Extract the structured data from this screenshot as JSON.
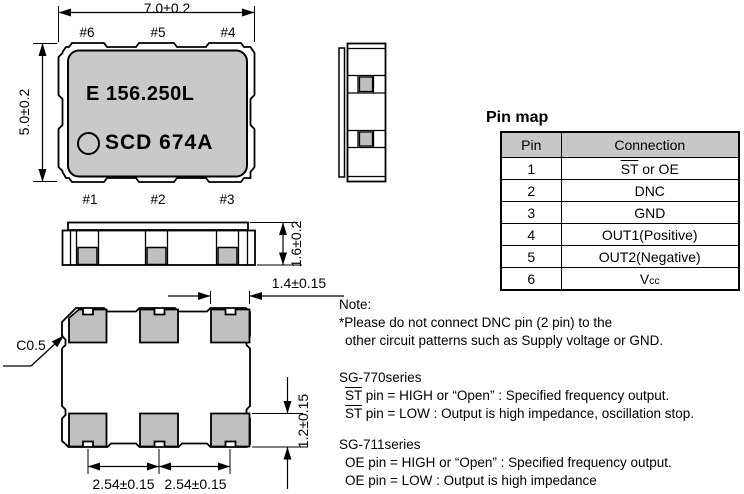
{
  "drawing": {
    "marking_line1": "E 156.250L",
    "marking_line2": "SCD 674A",
    "pin_labels_top": [
      "#6",
      "#5",
      "#4"
    ],
    "pin_labels_bottom": [
      "#1",
      "#2",
      "#3"
    ],
    "dims": {
      "body_width": "7.0±0.2",
      "body_height": "5.0±0.2",
      "package_thickness": "1.6±0.2",
      "pad_width": "1.4±0.15",
      "pad_height": "1.2±0.15",
      "pad_pitch_1": "2.54±0.15",
      "pad_pitch_2": "2.54±0.15",
      "chamfer": "C0.5"
    }
  },
  "pin_map": {
    "title": "Pin map",
    "headers": {
      "pin": "Pin",
      "connection": "Connection"
    },
    "rows": [
      {
        "pin": "1",
        "conn_overline": "ST",
        "conn_rest": " or OE"
      },
      {
        "pin": "2",
        "conn": "DNC"
      },
      {
        "pin": "3",
        "conn": "GND"
      },
      {
        "pin": "4",
        "conn": "OUT1(Positive)"
      },
      {
        "pin": "5",
        "conn": "OUT2(Negative)"
      },
      {
        "pin": "6",
        "conn_v": "V",
        "conn_sub": "cc"
      }
    ]
  },
  "notes": {
    "title": "Note:",
    "line1": "*Please do not connect DNC pin (2 pin) to the",
    "line2": "other circuit patterns such as Supply voltage or GND.",
    "sg770": {
      "heading": "SG-770series",
      "st1_overline": "ST",
      "st1_rest": " pin = HIGH or “Open” : Specified frequency output.",
      "st2_overline": "ST",
      "st2_rest": " pin = LOW : Output is high impedance, oscillation stop."
    },
    "sg711": {
      "heading": "SG-711series",
      "oe1": "OE pin = HIGH or “Open” : Specified frequency output.",
      "oe2": "OE pin = LOW : Output is high impedance"
    }
  },
  "colors": {
    "body_gray": "#c9c9c9",
    "pad_gray": "#c0c0c0",
    "table_header_gray": "#c8c8c8",
    "line_black": "#000000"
  }
}
